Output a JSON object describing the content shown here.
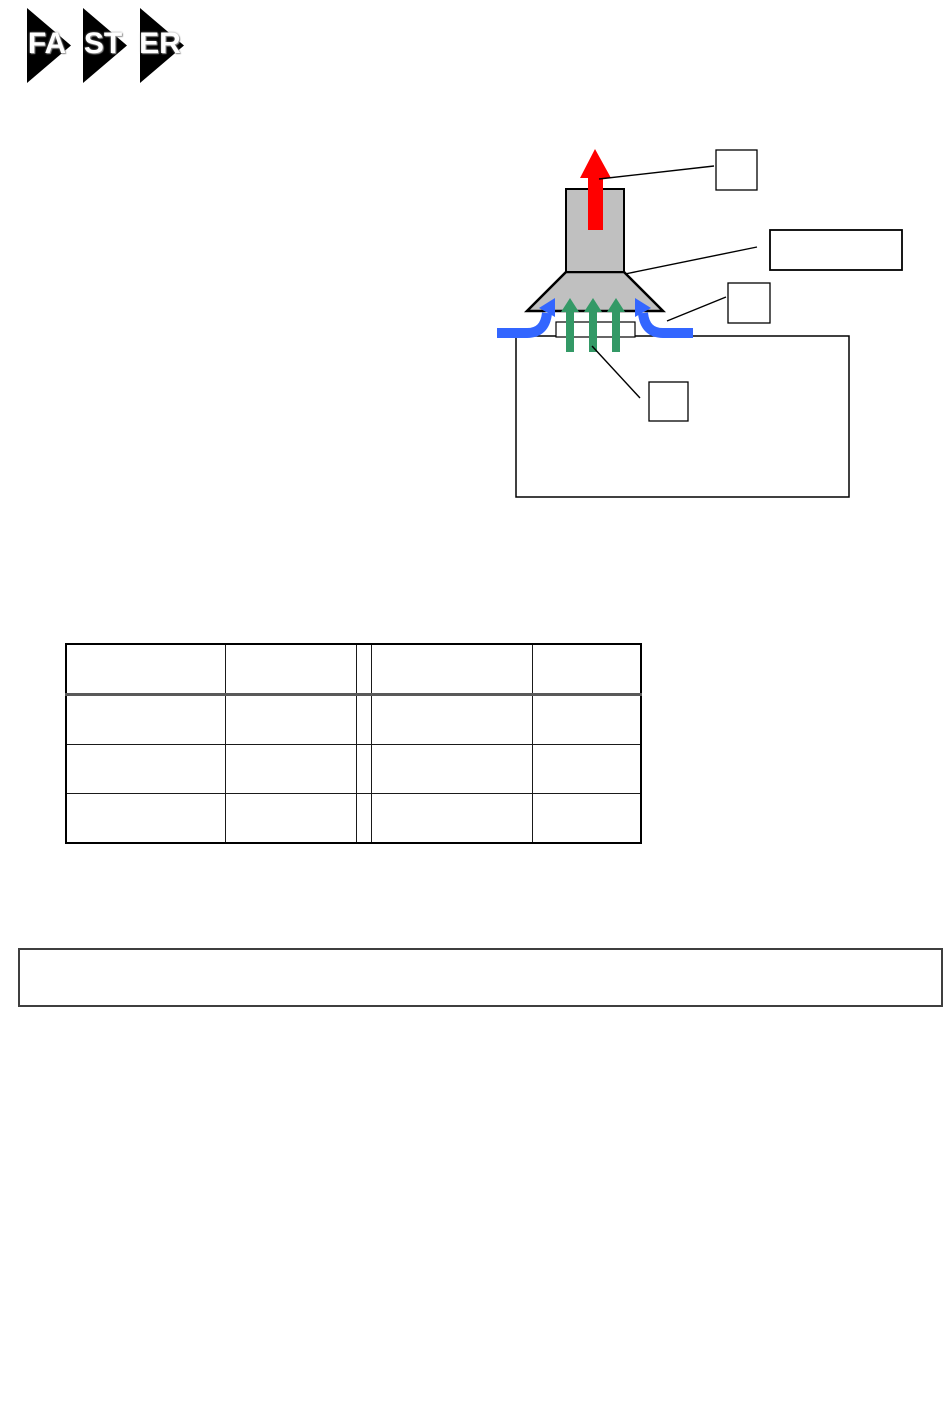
{
  "page": {
    "background": "#ffffff"
  },
  "logo": {
    "name": "FASTER",
    "segments": [
      {
        "label": "FA"
      },
      {
        "label": "ST"
      },
      {
        "label": "ER"
      }
    ],
    "triangle_color": "#000000",
    "text_color": "#ffffff"
  },
  "diagram": {
    "description": "fume-hood airflow schematic",
    "colors": {
      "duct_fill": "#c0c0c0",
      "outline": "#000000",
      "exhaust_arrow": "#ff0000",
      "air_curtain_arrow": "#3366ff",
      "plume_arrow": "#339966"
    },
    "callouts": [
      {
        "id": "exhaust-callout",
        "label": ""
      },
      {
        "id": "canopy-callout",
        "label": ""
      },
      {
        "id": "air-curtain-callout",
        "label": ""
      },
      {
        "id": "plume-callout",
        "label": ""
      }
    ]
  },
  "table": {
    "columns": [
      "",
      "",
      "",
      "",
      ""
    ],
    "rows": [
      [
        "",
        "",
        "",
        "",
        ""
      ],
      [
        "",
        "",
        "",
        "",
        ""
      ],
      [
        "",
        "",
        "",
        "",
        ""
      ],
      [
        "",
        "",
        "",
        "",
        ""
      ]
    ]
  },
  "note_box": {
    "text": ""
  }
}
